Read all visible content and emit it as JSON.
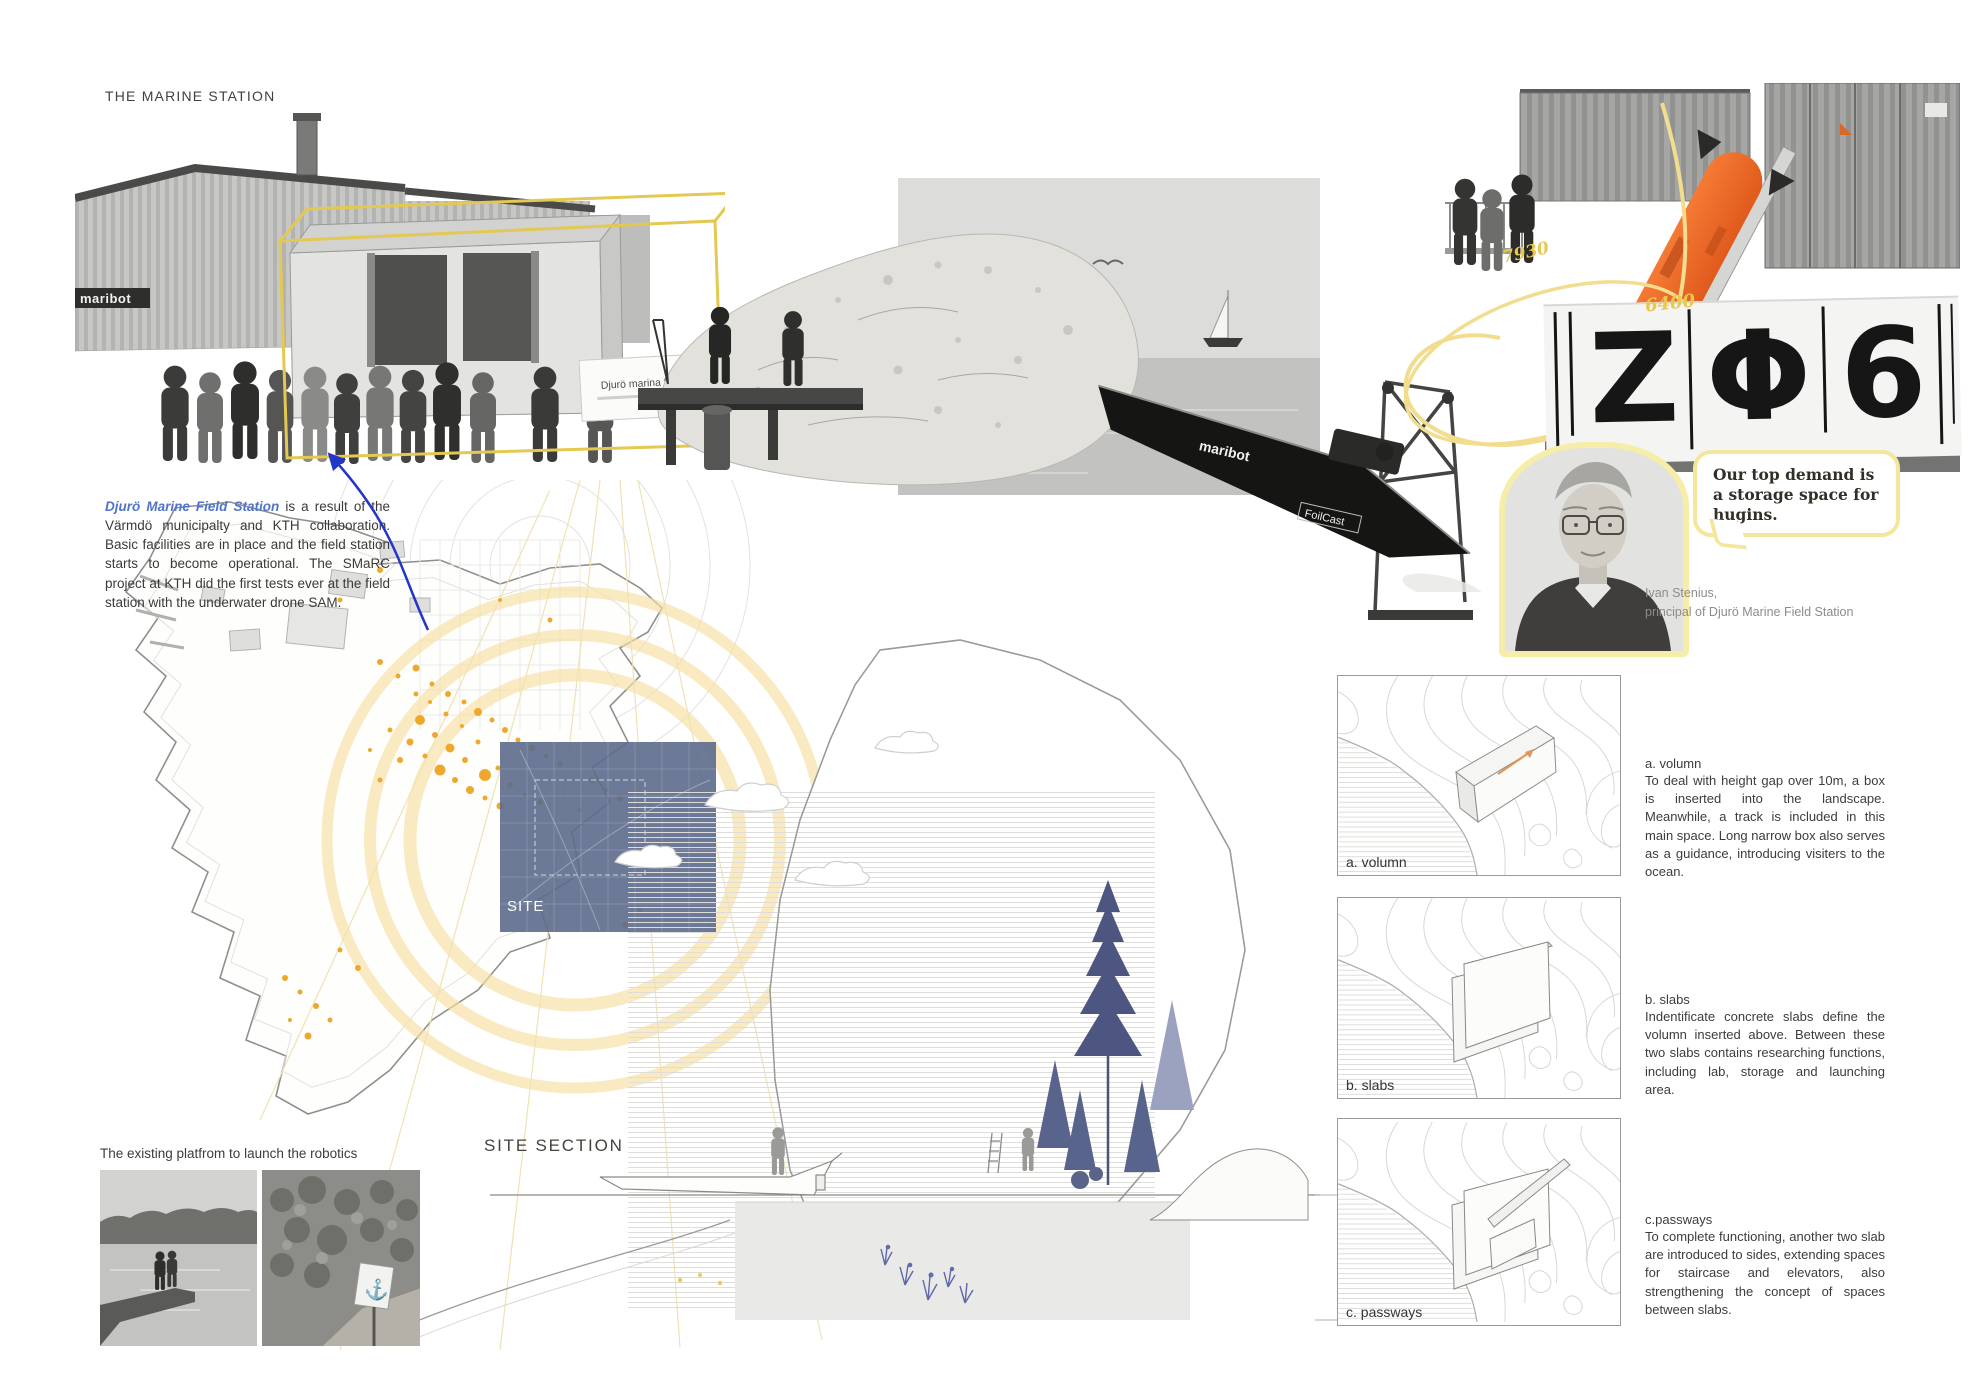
{
  "board": {
    "title": "THE MARINE STATION"
  },
  "intro": {
    "highlight": "Djurö Marine Field Station",
    "body": " is a result of the Värmdö municipalty and KTH collaboration. Basic facilities are in place and the field station starts to become operational. The SMaRC project at KTH did the first tests ever at the field station with the underwater drone SAM."
  },
  "photos": {
    "station": {
      "sign": "Djurö marina fältstation",
      "logo": "maribot"
    },
    "boat": {
      "logo": "maribot",
      "model": "FoilCast"
    },
    "hugin": {
      "dim_a": "7930",
      "dim_b": "6400",
      "hull_glyphs": {
        "g1": "Z",
        "g2": "Φ",
        "g3": "6"
      }
    }
  },
  "quote": {
    "text": "Our top demand is a storage space for hugins.",
    "name": "Ivan Stenius,",
    "role": "principal of Djurö Marine Field Station"
  },
  "map": {
    "site_label": "SITE"
  },
  "section": {
    "title": "SITE SECTION"
  },
  "platform": {
    "caption": "The existing platfrom to launch the robotics"
  },
  "diagrams": [
    {
      "label": "a. volumn",
      "heading": "a. volumn",
      "description": "To deal with height gap over 10m, a box is inserted into the landscape. Meanwhile, a track is included in this main space. Long narrow box also serves as a guidance, introducing visiters to the ocean."
    },
    {
      "label": "b. slabs",
      "heading": "b. slabs",
      "description": "Indentificate concrete slabs define the volumn inserted above. Between these two slabs contains researching functions, including lab, storage and launching area."
    },
    {
      "label": "c. passways",
      "heading": "c.passways",
      "description": "To complete functioning, another two slab are introduced to sides, extending spaces for staircase and elevators, also strengthening the concept of spaces between slabs."
    }
  ],
  "colors": {
    "accent_yellow": "#f4e69b",
    "dot_orange": "#f0a72e",
    "auv_orange": "#f4692a",
    "highlight_blue": "#4f74c8",
    "site_blue": "#5c6b8c"
  }
}
